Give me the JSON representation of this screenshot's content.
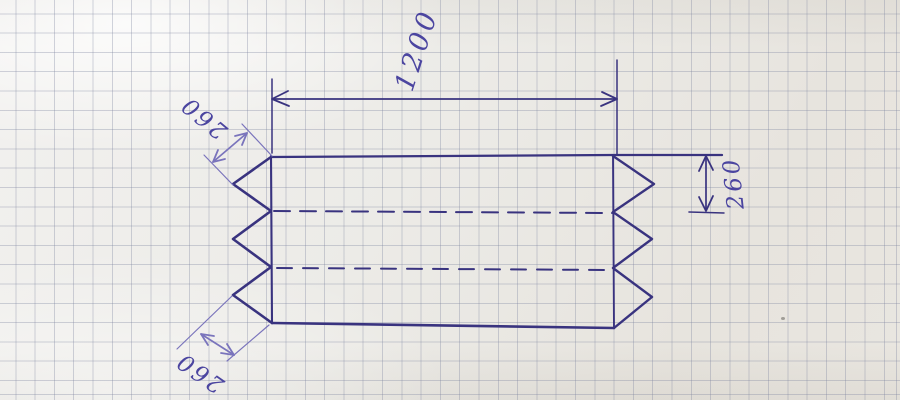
{
  "diagram": {
    "description": "hand-drawn fold-pattern sketch on squared paper",
    "labels": {
      "total_length": "1200",
      "fold_segment_upper_left": "260",
      "fold_segment_lower_left": "260",
      "panel_height_right": "260"
    },
    "colors": {
      "ink": "#39337f",
      "ink_thin": "#7a74bc",
      "text": "#4b45a0",
      "paper": "#edebe7",
      "grid": "#7c839e"
    }
  }
}
